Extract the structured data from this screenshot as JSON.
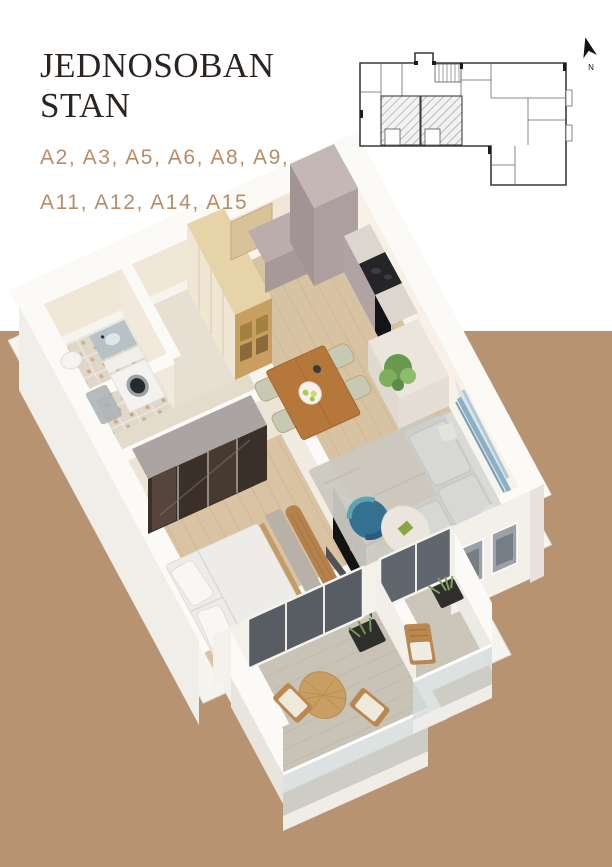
{
  "page": {
    "background_top": "#ffffff",
    "background_bottom": "#b79371"
  },
  "header": {
    "title_line1": "JEDNOSOBAN",
    "title_line2": "STAN",
    "title_color": "#2b2421",
    "unit_codes_line1": "A2, A3, A5, A6, A8, A9,",
    "unit_codes_line2": "A11, A12, A14, A15",
    "unit_codes_color": "#b68d68"
  },
  "site_plan": {
    "compass_label": "N",
    "highlighted_units": 2,
    "hatch_color": "#9b9b9b",
    "outline_color": "#3a3a3a"
  },
  "render_colors": {
    "outer_wall": "#f6f4ef",
    "inner_wall": "#f0e7d7",
    "wood_floor": "#d7c2a2",
    "bedroom_floor": "#d9c3a3",
    "balcony_floor": "#c9c2b6",
    "kitchen_cabinet": "#b1a3a4",
    "sofa": "#cdcfcc",
    "rug": "#cbc8c0",
    "wardrobe_glass": "#3a2f29",
    "dining_table": "#b5773a",
    "artwork_blue": "#7fa8bd"
  }
}
